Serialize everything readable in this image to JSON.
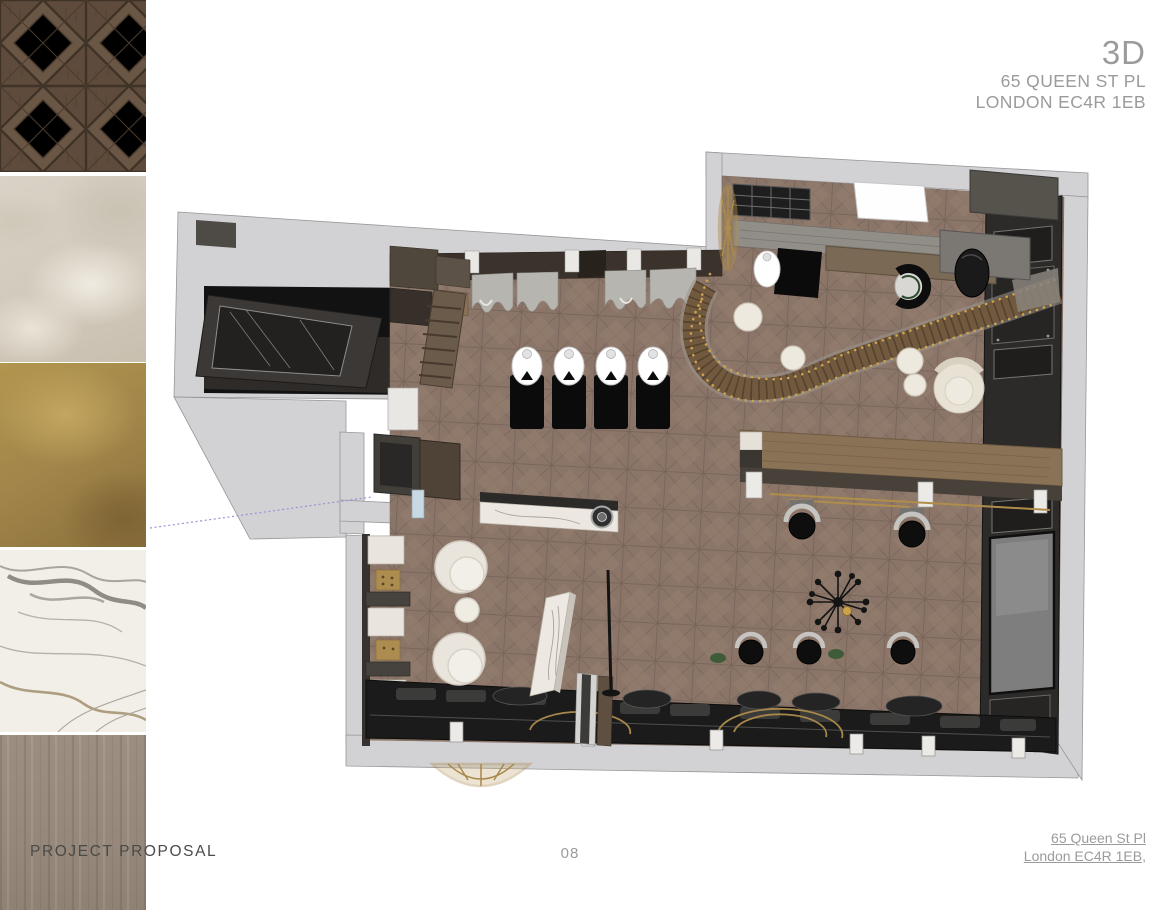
{
  "header": {
    "title": "3D",
    "address_line1": "65 QUEEN ST PL",
    "address_line2": "LONDON EC4R 1EB",
    "text_color": "#9B9B9B"
  },
  "footer": {
    "proposal_label": "PROJECT PROPOSAL",
    "page_number": "08",
    "address_line1": "65 Queen St Pl",
    "address_line2": "London EC4R 1EB,",
    "label_color": "#4A4A47",
    "muted_color": "#9B9B9B"
  },
  "material_swatches": [
    {
      "name": "dark-walnut-versailles-parquet",
      "base_color": "#5E4B3C"
    },
    {
      "name": "beige-plaster-stone",
      "base_color": "#D5CEC1"
    },
    {
      "name": "antique-brass-gold",
      "base_color": "#A5874C"
    },
    {
      "name": "calacatta-white-marble",
      "base_color": "#F2EFE9"
    },
    {
      "name": "grey-oak-wood",
      "base_color": "#968878"
    }
  ],
  "floor_plan": {
    "name": "3d-top-view-salon-floor-plan",
    "colors": {
      "wall": "#D2D2D4",
      "floor_parquet": "#8B7568",
      "dark_furniture": "#1C1C1C",
      "wood_furniture": "#8A7257",
      "gold_accent": "#B08D4A",
      "marble": "#ECE8E1",
      "cream_upholstery": "#EFECE5",
      "curtain_grey": "#B7B5B0"
    },
    "areas": [
      "bathroom",
      "styling-stations",
      "curtained-mirror-wall",
      "curved-staircase",
      "skylight",
      "bar-table-with-stools",
      "tv-panel-wall",
      "bench-lounge",
      "retail-shelving",
      "reception-vestibule"
    ]
  }
}
